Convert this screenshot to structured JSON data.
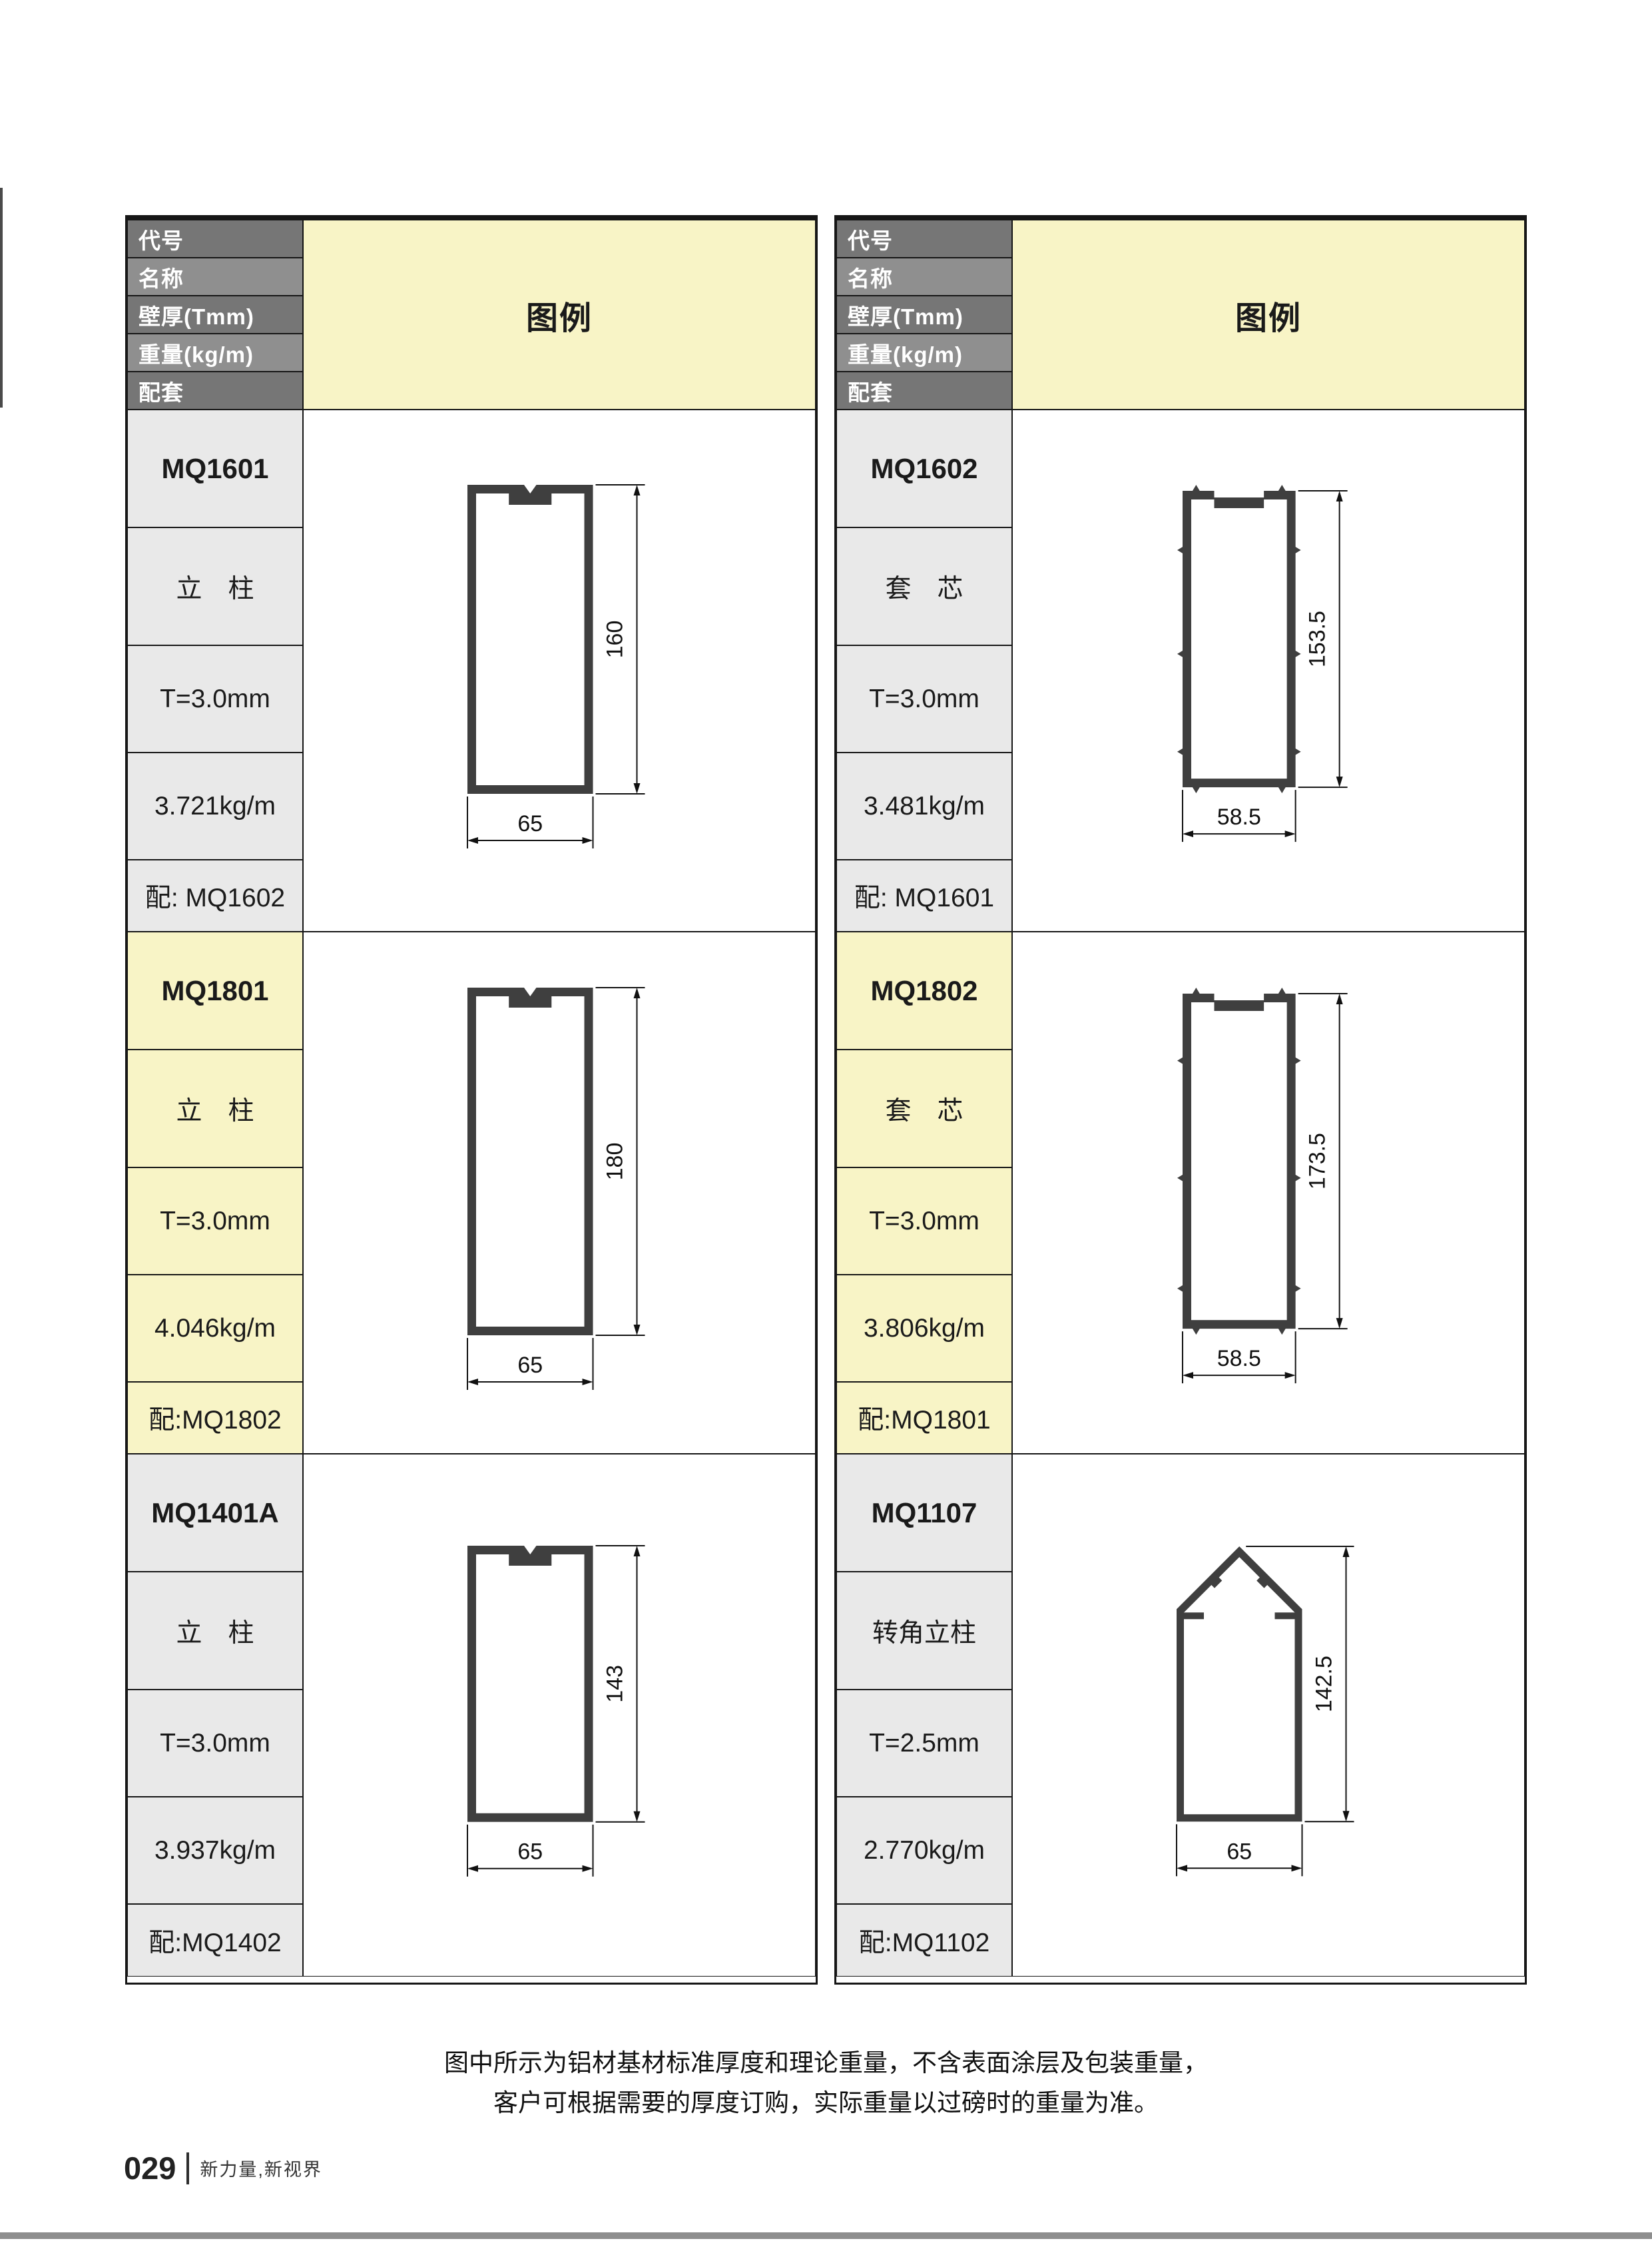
{
  "colors": {
    "section_yellow": "#f8f4c6",
    "section_gray": "#e9e9e9",
    "header_dark_gray": "#767676",
    "header_light_gray": "#8f8f8f",
    "profile_fill": "#3f3f3f",
    "line_black": "#111111"
  },
  "table_headers": {
    "code": "代号",
    "name": "名称",
    "thickness": "壁厚(Tmm)",
    "weight": "重量(kg/m)",
    "match": "配套",
    "legend": "图例"
  },
  "profiles": [
    {
      "code": "MQ1601",
      "name": "立　柱",
      "thickness": "T=3.0mm",
      "weight": "3.721kg/m",
      "match": "配: MQ1602",
      "shape": "column",
      "dim_height": "160",
      "dim_width": "65"
    },
    {
      "code": "MQ1602",
      "name": "套　芯",
      "thickness": "T=3.0mm",
      "weight": "3.481kg/m",
      "match": "配: MQ1601",
      "shape": "core",
      "dim_height": "153.5",
      "dim_width": "58.5"
    },
    {
      "code": "MQ1801",
      "name": "立　柱",
      "thickness": "T=3.0mm",
      "weight": "4.046kg/m",
      "match": "配:MQ1802",
      "shape": "column",
      "dim_height": "180",
      "dim_width": "65"
    },
    {
      "code": "MQ1802",
      "name": "套　芯",
      "thickness": "T=3.0mm",
      "weight": "3.806kg/m",
      "match": "配:MQ1801",
      "shape": "core",
      "dim_height": "173.5",
      "dim_width": "58.5"
    },
    {
      "code": "MQ1401A",
      "name": "立　柱",
      "thickness": "T=3.0mm",
      "weight": "3.937kg/m",
      "match": "配:MQ1402",
      "shape": "column",
      "dim_height": "143",
      "dim_width": "65"
    },
    {
      "code": "MQ1107",
      "name": "转角立柱",
      "thickness": "T=2.5mm",
      "weight": "2.770kg/m",
      "match": "配:MQ1102",
      "shape": "corner",
      "dim_height": "142.5",
      "dim_width": "65"
    }
  ],
  "note": {
    "line1": "图中所示为铝材基材标准厚度和理论重量，不含表面涂层及包装重量，",
    "line2": "客户可根据需要的厚度订购，实际重量以过磅时的重量为准。"
  },
  "footer": {
    "page_number": "029",
    "slogan": "新力量,新视界"
  }
}
